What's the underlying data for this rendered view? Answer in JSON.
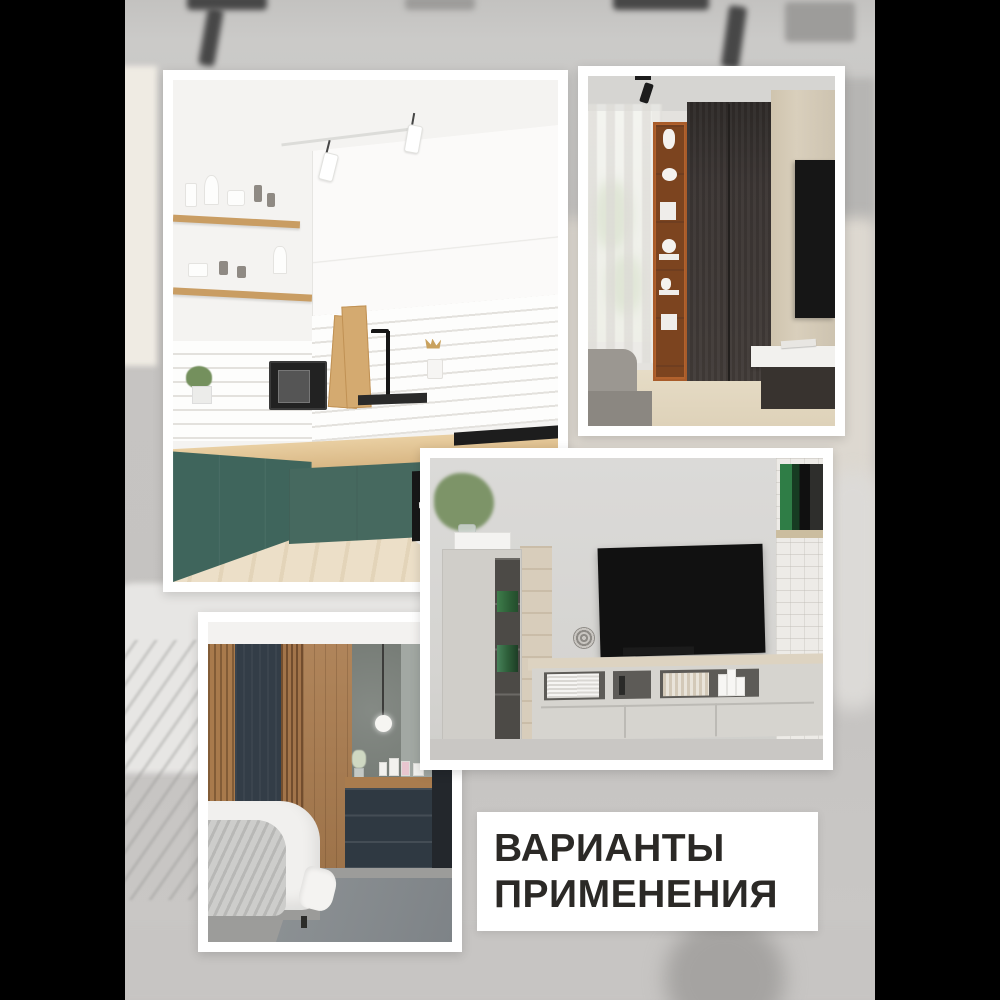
{
  "page": {
    "kind": "product-collage",
    "background_color": "#000000",
    "content_background": "blurred grayscale interior photo"
  },
  "caption": {
    "line1": "ВАРИАНТЫ",
    "line2": "ПРИМЕНЕНИЯ",
    "text_color": "#2b2926",
    "box_color": "#ffffff"
  },
  "photos": [
    {
      "id": "kitchen",
      "label": "Кухня: зелёные нижние фасады, белые верхние шкафы, деревянная столешница, белая плитка, светлый пол"
    },
    {
      "id": "wardrobe",
      "label": "Спальня: тёмный шкаф, оранжевый открытый стеллаж с декором, окно с тюлем, телевизор"
    },
    {
      "id": "tvroom",
      "label": "Гостиная: чёрный телевизор на стене, светлая тумба и шкаф, белая кирпичная колонна"
    },
    {
      "id": "bedroom",
      "label": "Спальня: деревянные рейки и тёмные панели, туалетный столик, подвесной светильник, кровать"
    }
  ],
  "palette": {
    "pillarbox": "#000000",
    "backdrop_gray": "#c7c5c3",
    "frame_white": "#ffffff",
    "kitchen_teal": "#44685f",
    "kitchen_counter_wood": "#d8b683",
    "wardrobe_dark_brown": "#3a3432",
    "shelf_orange": "#b2622d",
    "bedroom_panel_dark": "#333d47",
    "bedroom_wood": "#a87a4c",
    "tv_black": "#111111",
    "bench_oak": "#ddd3c1"
  }
}
